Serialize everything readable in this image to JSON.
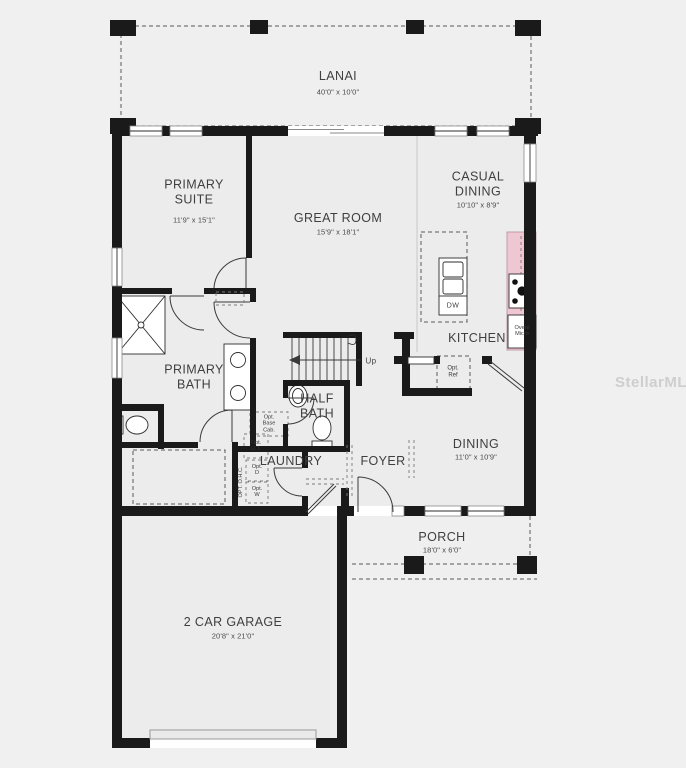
{
  "watermark": {
    "text": "StellarMLS"
  },
  "rooms": {
    "lanai": {
      "name": "LANAI",
      "dims": "40'0\" x 10'0\""
    },
    "primary_suite": {
      "name": "PRIMARY SUITE",
      "dims": "11'9\" x 15'1\""
    },
    "great_room": {
      "name": "GREAT ROOM",
      "dims": "15'9\" x 18'1\""
    },
    "casual_dining": {
      "name": "CASUAL DINING",
      "dims": "10'10\" x 8'9\""
    },
    "kitchen": {
      "name": "KITCHEN"
    },
    "primary_bath": {
      "name": "PRIMARY BATH"
    },
    "half_bath": {
      "name": "HALF BATH"
    },
    "laundry": {
      "name": "LAUNDRY"
    },
    "foyer": {
      "name": "FOYER"
    },
    "dining": {
      "name": "DINING",
      "dims": "11'0\" x 10'9\""
    },
    "porch": {
      "name": "PORCH",
      "dims": "18'0\" x 6'0\""
    },
    "garage": {
      "name": "2 CAR GARAGE",
      "dims": "20'8\" x 21'0\""
    }
  },
  "annotations": {
    "up": "Up",
    "dw": "DW",
    "oven_micro": "Oven/ Micro",
    "opt_ref": "Opt. Ref",
    "opt_base_cab": "Opt. Base Cab.",
    "opt_ut": "Opt. U.T.",
    "opt_ohc": "OPT. O.H.C.",
    "opt_d": "Opt. D",
    "opt_w": "Opt. W"
  },
  "colors": {
    "wall": "#1a1a1a",
    "counter_pink": "#efc7d2",
    "background": "#f0f0f0",
    "floor": "#ededed",
    "label_text": "#3f3f3f"
  }
}
